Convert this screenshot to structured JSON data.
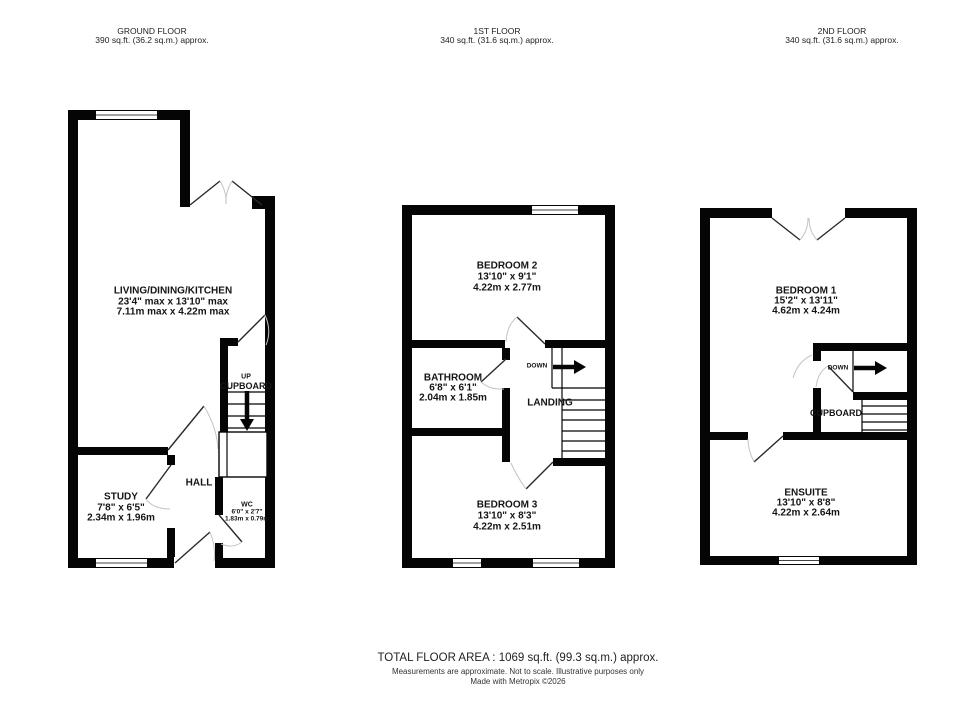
{
  "ground": {
    "title": "GROUND FLOOR",
    "area": "390 sq.ft. (36.2 sq.m.) approx.",
    "living_name": "LIVING/DINING/KITCHEN",
    "living_imp": "23'4\" max x 13'10\" max",
    "living_met": "7.11m max x 4.22m max",
    "up": "UP",
    "cupboard": "CUPBOARD",
    "hall": "HALL",
    "study_name": "STUDY",
    "study_imp": "7'8\"  x 6'5\"",
    "study_met": "2.34m  x 1.96m",
    "wc_name": "WC",
    "wc_imp": "6'0\"  x 2'7\"",
    "wc_met": "1.83m  x 0.79m"
  },
  "first": {
    "title": "1ST FLOOR",
    "area": "340 sq.ft. (31.6 sq.m.) approx.",
    "bed2_name": "BEDROOM 2",
    "bed2_imp": "13'10\"  x 9'1\"",
    "bed2_met": "4.22m  x 2.77m",
    "bath_name": "BATHROOM",
    "bath_imp": "6'8\"  x 6'1\"",
    "bath_met": "2.04m  x 1.85m",
    "down": "DOWN",
    "landing": "LANDING",
    "bed3_name": "BEDROOM 3",
    "bed3_imp": "13'10\"  x 8'3\"",
    "bed3_met": "4.22m  x 2.51m"
  },
  "second": {
    "title": "2ND FLOOR",
    "area": "340 sq.ft. (31.6 sq.m.) approx.",
    "bed1_name": "BEDROOM 1",
    "bed1_imp": "15'2\"  x 13'11\"",
    "bed1_met": "4.62m  x 4.24m",
    "down": "DOWN",
    "cupboard": "CUPBOARD",
    "ensuite_name": "ENSUITE",
    "ensuite_imp": "13'10\"  x 8'8\"",
    "ensuite_met": "4.22m  x 2.64m"
  },
  "footer": {
    "total": "TOTAL FLOOR AREA : 1069 sq.ft. (99.3 sq.m.) approx.",
    "disclaimer": "Measurements are approximate.  Not to scale.  Illustrative purposes only",
    "credit": "Made with Metropix ©2026"
  }
}
